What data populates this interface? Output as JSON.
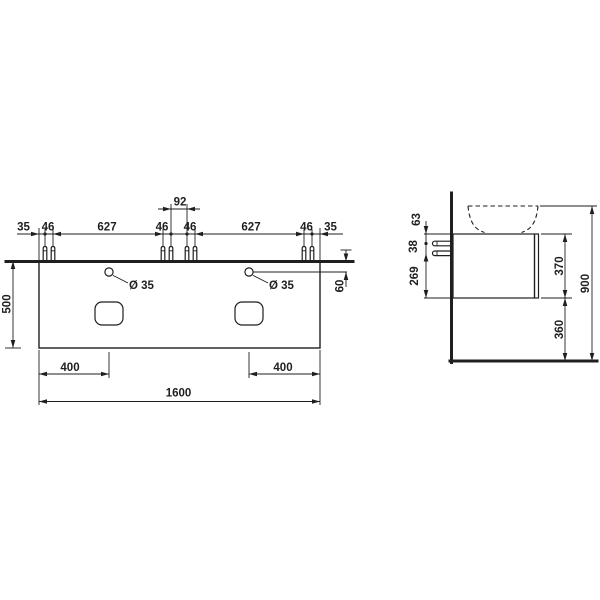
{
  "colors": {
    "line": "#1f1f1f",
    "background": "#ffffff"
  },
  "front_view": {
    "top_chain": [
      "35",
      "46",
      "627",
      "46",
      "46",
      "627",
      "46",
      "35"
    ],
    "bolt_pair_gap": "92",
    "depth": "500",
    "hole_left": "Ø 35",
    "hole_right": "Ø 35",
    "hole_back_offset": "60",
    "cutout_left_offset": "400",
    "cutout_right_offset": "400",
    "total_width": "1600"
  },
  "side_view": {
    "top_to_bolt": "63",
    "bolt_gap": "38",
    "bolt_to_bottom": "269",
    "cabinet_height": "370",
    "floor_clearance": "360",
    "total_height": "900"
  }
}
